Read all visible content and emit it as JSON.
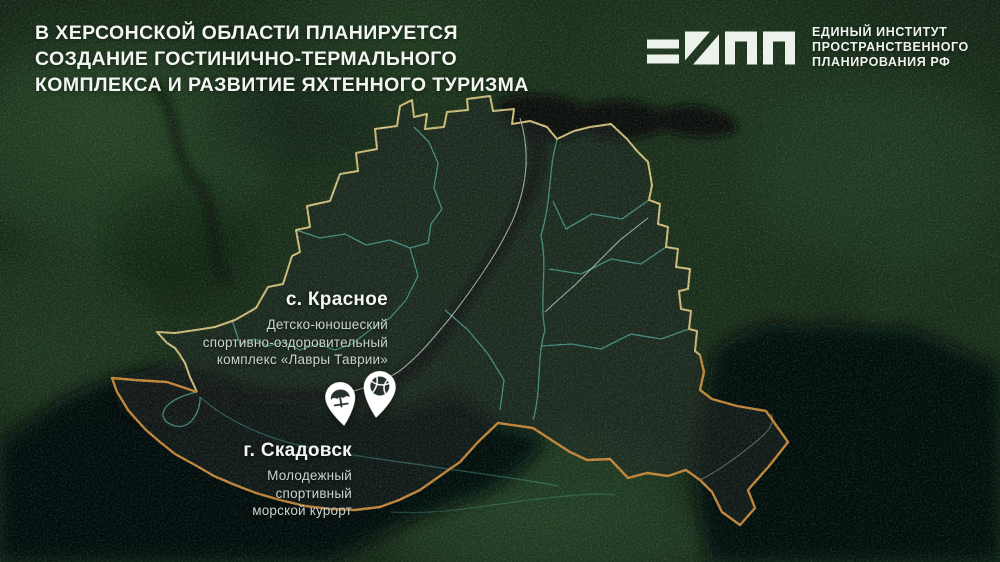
{
  "title": {
    "lines": [
      "В ХЕРСОНСКОЙ ОБЛАСТИ ПЛАНИРУЕТСЯ",
      "СОЗДАНИЕ ГОСТИНИЧНО-ТЕРМАЛЬНОГО",
      "КОМПЛЕКСА И РАЗВИТИЕ ЯХТЕННОГО ТУРИЗМА"
    ]
  },
  "logo": {
    "icon": "eipp-geometric-mark",
    "org_lines": [
      "ЕДИНЫЙ ИНСТИТУТ",
      "ПРОСТРАНСТВЕННОГО",
      "ПЛАНИРОВАНИЯ РФ"
    ]
  },
  "map": {
    "places": [
      {
        "settlement": "с. Красное",
        "description_lines": [
          "Детско-юношеский",
          "спортивно-оздоровительный",
          "комплекс «Лавры Таврии»"
        ]
      },
      {
        "settlement": "г. Скадовск",
        "description_lines": [
          "Молодежный",
          "спортивный",
          "морской курорт"
        ]
      }
    ],
    "pins": [
      {
        "icon": "beach-umbrella-icon"
      },
      {
        "icon": "volleyball-icon"
      }
    ],
    "colors": {
      "region_border_north": "#ecd98e",
      "region_border_coast": "#df9a42",
      "district_lines": "#5fc4b4",
      "river_lines": "#dfe9e2",
      "pin_fill": "#ffffff",
      "pin_glyph": "#26312b",
      "title_text": "#f2f5f0"
    }
  }
}
